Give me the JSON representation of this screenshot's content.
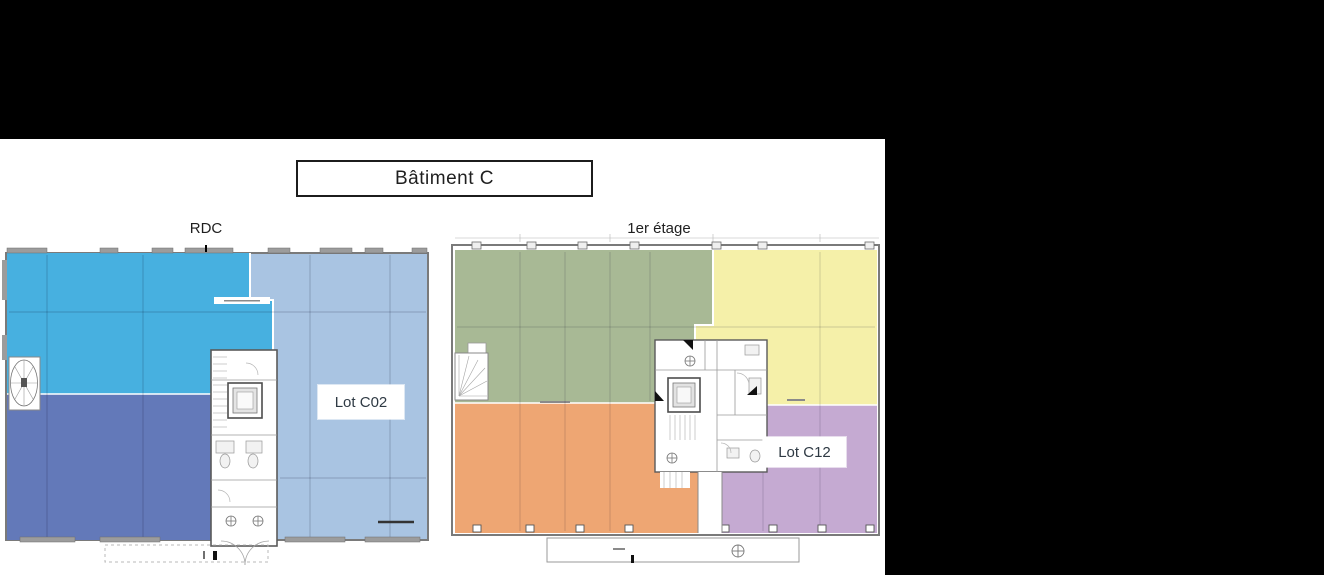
{
  "title": {
    "label": "Bâtiment C"
  },
  "floors": {
    "rdc": {
      "label": "RDC",
      "lot_label": "Lot C02",
      "zone_names": [
        "upper-left-unit",
        "lower-left-unit",
        "lot-c02-unit"
      ]
    },
    "etage1": {
      "label": "1er étage",
      "lot_label": "Lot C12",
      "zone_names": [
        "north-west-unit",
        "north-east-unit",
        "south-west-unit",
        "lot-c12-unit"
      ]
    }
  },
  "colors": {
    "canvas_bg": "#000000",
    "sheet_bg": "#ffffff",
    "rdc_bright_blue": "#47b0e0",
    "rdc_dark_blue": "#6379b9",
    "rdc_light_blue": "#a9c4e2",
    "etage_green": "#a8b995",
    "etage_yellow": "#f5f0a9",
    "etage_orange": "#eea673",
    "etage_purple": "#c5aad2",
    "wall_gray": "#9c9c9c",
    "core_fill": "#ffffff"
  }
}
